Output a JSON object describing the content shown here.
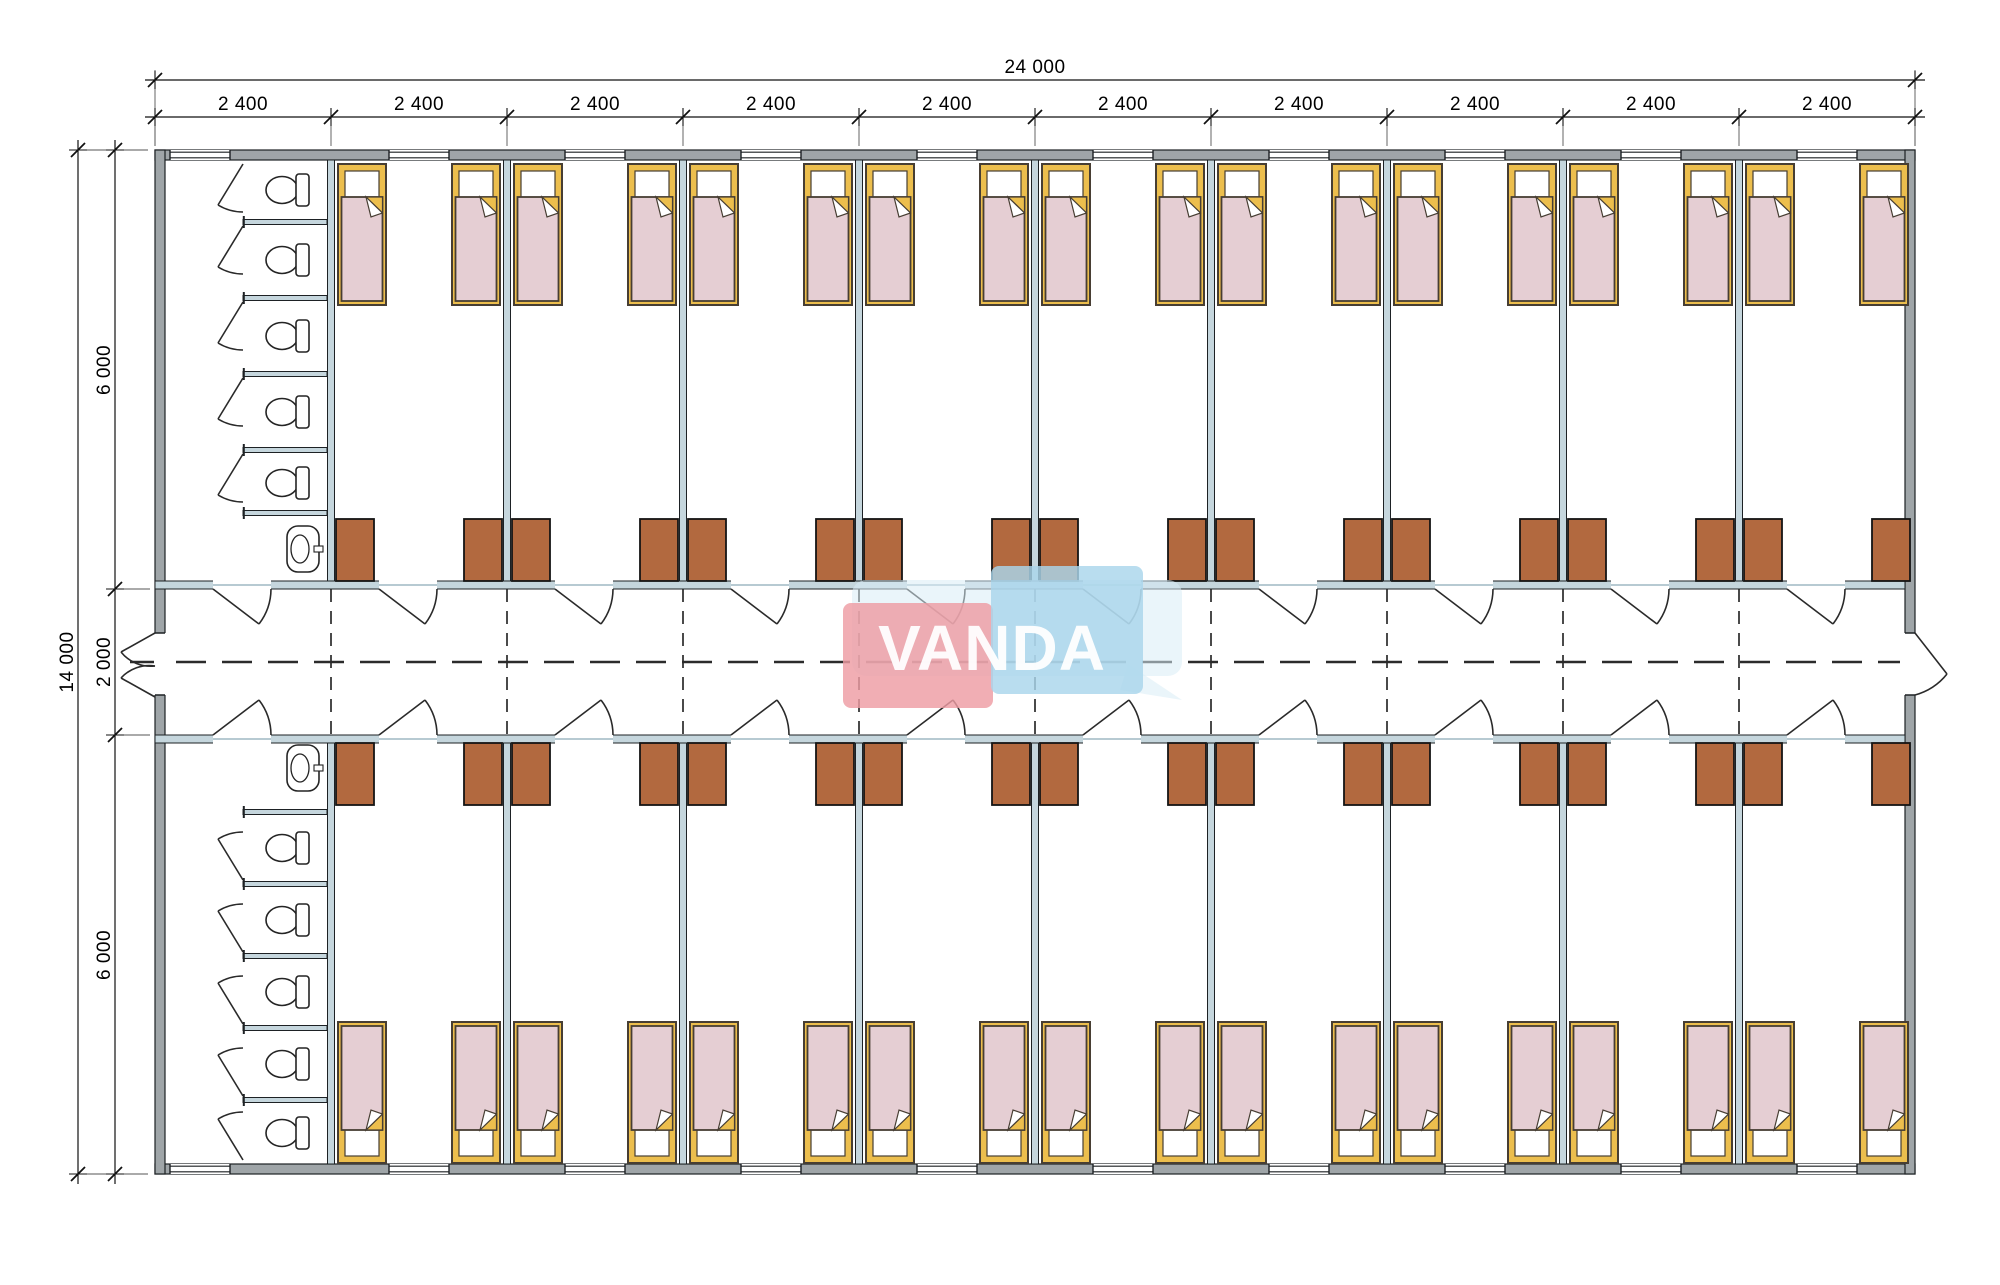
{
  "title": "Modular dormitory floor plan",
  "watermark": {
    "brand": "VANDA"
  },
  "dimensions": {
    "overall_width": "24 000",
    "overall_height": "14 000",
    "bays": [
      "2 400",
      "2 400",
      "2 400",
      "2 400",
      "2 400",
      "2 400",
      "2 400",
      "2 400",
      "2 400",
      "2 400"
    ],
    "height_segments": [
      "6 000",
      "2 000",
      "6 000"
    ]
  },
  "plan": {
    "rows_of_rooms": 2,
    "rooms_per_row": 9,
    "beds_per_room": 2,
    "wardrobes_per_room": 2,
    "bathrooms": 2,
    "toilets_per_bathroom": 5,
    "sinks_per_bathroom": 1,
    "corridor": "central corridor with exit doors at both ends"
  },
  "colors": {
    "wall_gray": "#9FA5A8",
    "wall_light": "#C5D6DD",
    "line_dark": "#1D2124",
    "bed_yellow": "#ECBE4D",
    "bed_pink": "#E5CED3",
    "bed_outline": "#473E33",
    "wardrobe_brown": "#B2693F",
    "wm_red": "#EE9CA4",
    "wm_blue": "#A9D5EC",
    "wm_pale": "#D9EDF6",
    "wm_text": "#FFFFFF"
  }
}
